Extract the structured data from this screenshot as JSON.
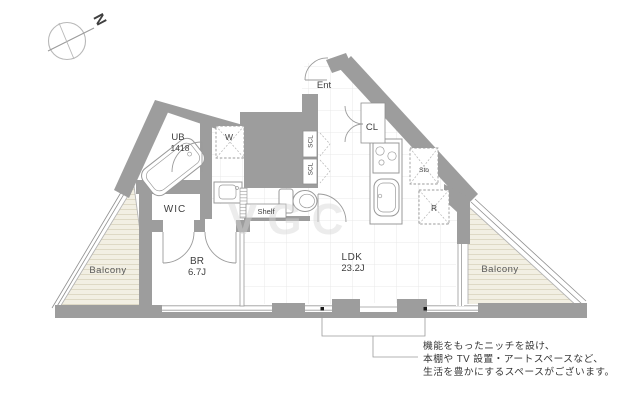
{
  "compass": {
    "north_label": "N"
  },
  "floor_plan": {
    "rooms": {
      "ent": {
        "label": "Ent"
      },
      "closet": {
        "label": "CL"
      },
      "shoe_closet_upper": {
        "label": "SCL"
      },
      "shoe_closet_lower": {
        "label": "SCL"
      },
      "unit_bath": {
        "label": "UB",
        "size": "1418"
      },
      "washer": {
        "label": "W"
      },
      "walk_in_closet": {
        "label": "WIC"
      },
      "bedroom": {
        "label": "BR",
        "size": "6.7J"
      },
      "living_dining_kitchen": {
        "label": "LDK",
        "size": "23.2J"
      },
      "storage": {
        "label": "Sto"
      },
      "refrigerator": {
        "label": "R"
      },
      "shelf": {
        "label": "Shelf"
      },
      "balcony_left": {
        "label": "Balcony"
      },
      "balcony_right": {
        "label": "Balcony"
      }
    },
    "annotation": {
      "lines": [
        "機能をもったニッチを設け、",
        "本棚や TV 設置・アートスペースなど、",
        "生活を豊かにするスペースがございます。"
      ]
    },
    "watermark": "VGC"
  },
  "colors": {
    "wall": "#9d9d9d",
    "balcony_fill": "#f2efe3",
    "balcony_stripe": "#ded9c5",
    "grid": "#e8e8e8",
    "outline": "#999999",
    "label_text": "#3f3f3f",
    "annotation_text": "#383838"
  }
}
